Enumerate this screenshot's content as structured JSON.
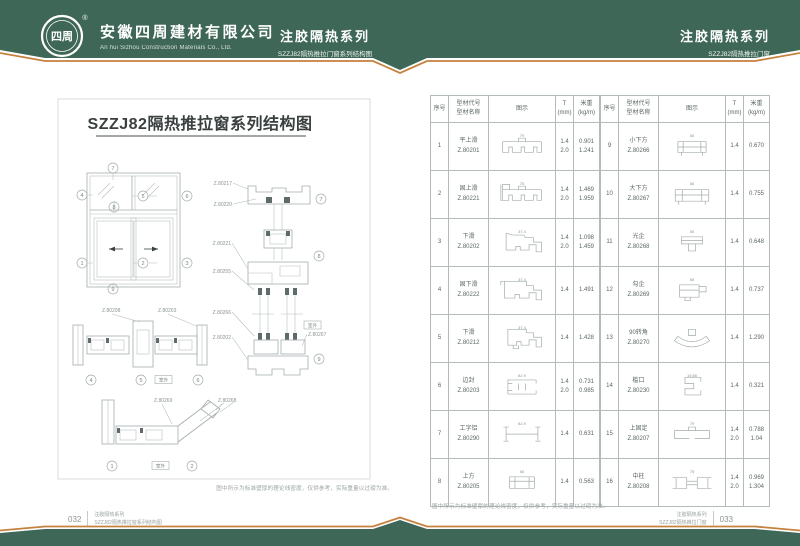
{
  "theme": {
    "green": "#3e6758",
    "orange": "#c5813e"
  },
  "header": {
    "logo_text": "四周",
    "logo_reg": "®",
    "company_cn": "安徽四周建材有限公司",
    "company_en": "An hui Sizhou Construction Materials Co., Ltd.",
    "center_title": "注胶隔热系列",
    "center_subtitle": "SZZJ82隔热推拉门窗系列结构图",
    "right_title": "注胶隔热系列",
    "right_subtitle": "SZZJ82隔热推拉门窗"
  },
  "left_page": {
    "title": "SZZJ82隔热推拉窗系列结构图",
    "callouts": [
      "1",
      "2",
      "3",
      "4",
      "5",
      "6",
      "7",
      "8",
      "9"
    ],
    "vlabels": [
      "Z.80217",
      "Z.80220",
      "Z.80221",
      "Z.80255",
      "Z.80266",
      "Z.80202",
      "Z.80267"
    ],
    "h1labels": [
      "Z.80208",
      "Z.80203"
    ],
    "h2labels": [
      "Z.80269",
      "Z.80268"
    ],
    "outdoor": "室外",
    "note": "图中所示为标准壁厚的理论线密度，仅供参考，实际重量以过磅为准。"
  },
  "table": {
    "headers": {
      "no": "序号",
      "code_name": "型材代号\n型材名称",
      "diagram": "图示",
      "t": "T\n(mm)",
      "weight": "米重\n(kg/m)"
    },
    "note": "图中所示为标准壁厚的理论线密度，仅供参考，实际重量以过磅为准。",
    "rows": [
      {
        "no": "1",
        "name": "平上滑",
        "code": "Z.80201",
        "t": "1.4\n2.0",
        "w": "0.901\n1.241",
        "dim": "79"
      },
      {
        "no": "2",
        "name": "固上滑",
        "code": "Z.80221",
        "t": "1.4\n2.0",
        "w": "1.469\n1.959",
        "dim": "70"
      },
      {
        "no": "3",
        "name": "下滑",
        "code": "Z.80202",
        "t": "1.4\n2.0",
        "w": "1.098\n1.459",
        "dim": "37.4"
      },
      {
        "no": "4",
        "name": "固下滑",
        "code": "Z.80222",
        "t": "1.4",
        "w": "1.491",
        "dim": "37.4"
      },
      {
        "no": "5",
        "name": "下滑",
        "code": "Z.80212",
        "t": "1.4",
        "w": "1.428",
        "dim": "37.4"
      },
      {
        "no": "6",
        "name": "边封",
        "code": "Z.80203",
        "t": "1.4\n2.0",
        "w": "0.731\n0.985",
        "dim": "82.9"
      },
      {
        "no": "7",
        "name": "工字铝",
        "code": "Z.80290",
        "t": "1.4",
        "w": "0.631",
        "dim": "82.9"
      },
      {
        "no": "8",
        "name": "上方",
        "code": "Z.80205",
        "t": "1.4",
        "w": "0.563",
        "dim": "60"
      },
      {
        "no": "9",
        "name": "小下方",
        "code": "Z.80266",
        "t": "1.4",
        "w": "0.670",
        "dim": "60"
      },
      {
        "no": "10",
        "name": "大下方",
        "code": "Z.80267",
        "t": "1.4",
        "w": "0.755",
        "dim": "66"
      },
      {
        "no": "11",
        "name": "光企",
        "code": "Z.80268",
        "t": "1.4",
        "w": "0.648",
        "dim": "50"
      },
      {
        "no": "12",
        "name": "勾企",
        "code": "Z.80269",
        "t": "1.4",
        "w": "0.737",
        "dim": "58"
      },
      {
        "no": "13",
        "name": "90转角",
        "code": "Z.80270",
        "t": "1.4",
        "w": "1.290",
        "dim": ""
      },
      {
        "no": "14",
        "name": "槛口",
        "code": "Z.80230",
        "t": "1.4",
        "w": "0.321",
        "dim": "19.85"
      },
      {
        "no": "15",
        "name": "上固定",
        "code": "Z.80207",
        "t": "1.4\n2.0",
        "w": "0.788\n1.04",
        "dim": "79"
      },
      {
        "no": "16",
        "name": "中柱",
        "code": "Z.80208",
        "t": "1.4\n2.0",
        "w": "0.969\n1.304",
        "dim": "75"
      }
    ]
  },
  "footer": {
    "left_page_no": "032",
    "left_series": "注胶隔热系列",
    "left_doc": "SZZJ82隔热推拉窗系列结构图",
    "right_series": "注胶隔热系列",
    "right_doc": "SZZJ82隔热推拉门窗",
    "right_page_no": "033"
  }
}
